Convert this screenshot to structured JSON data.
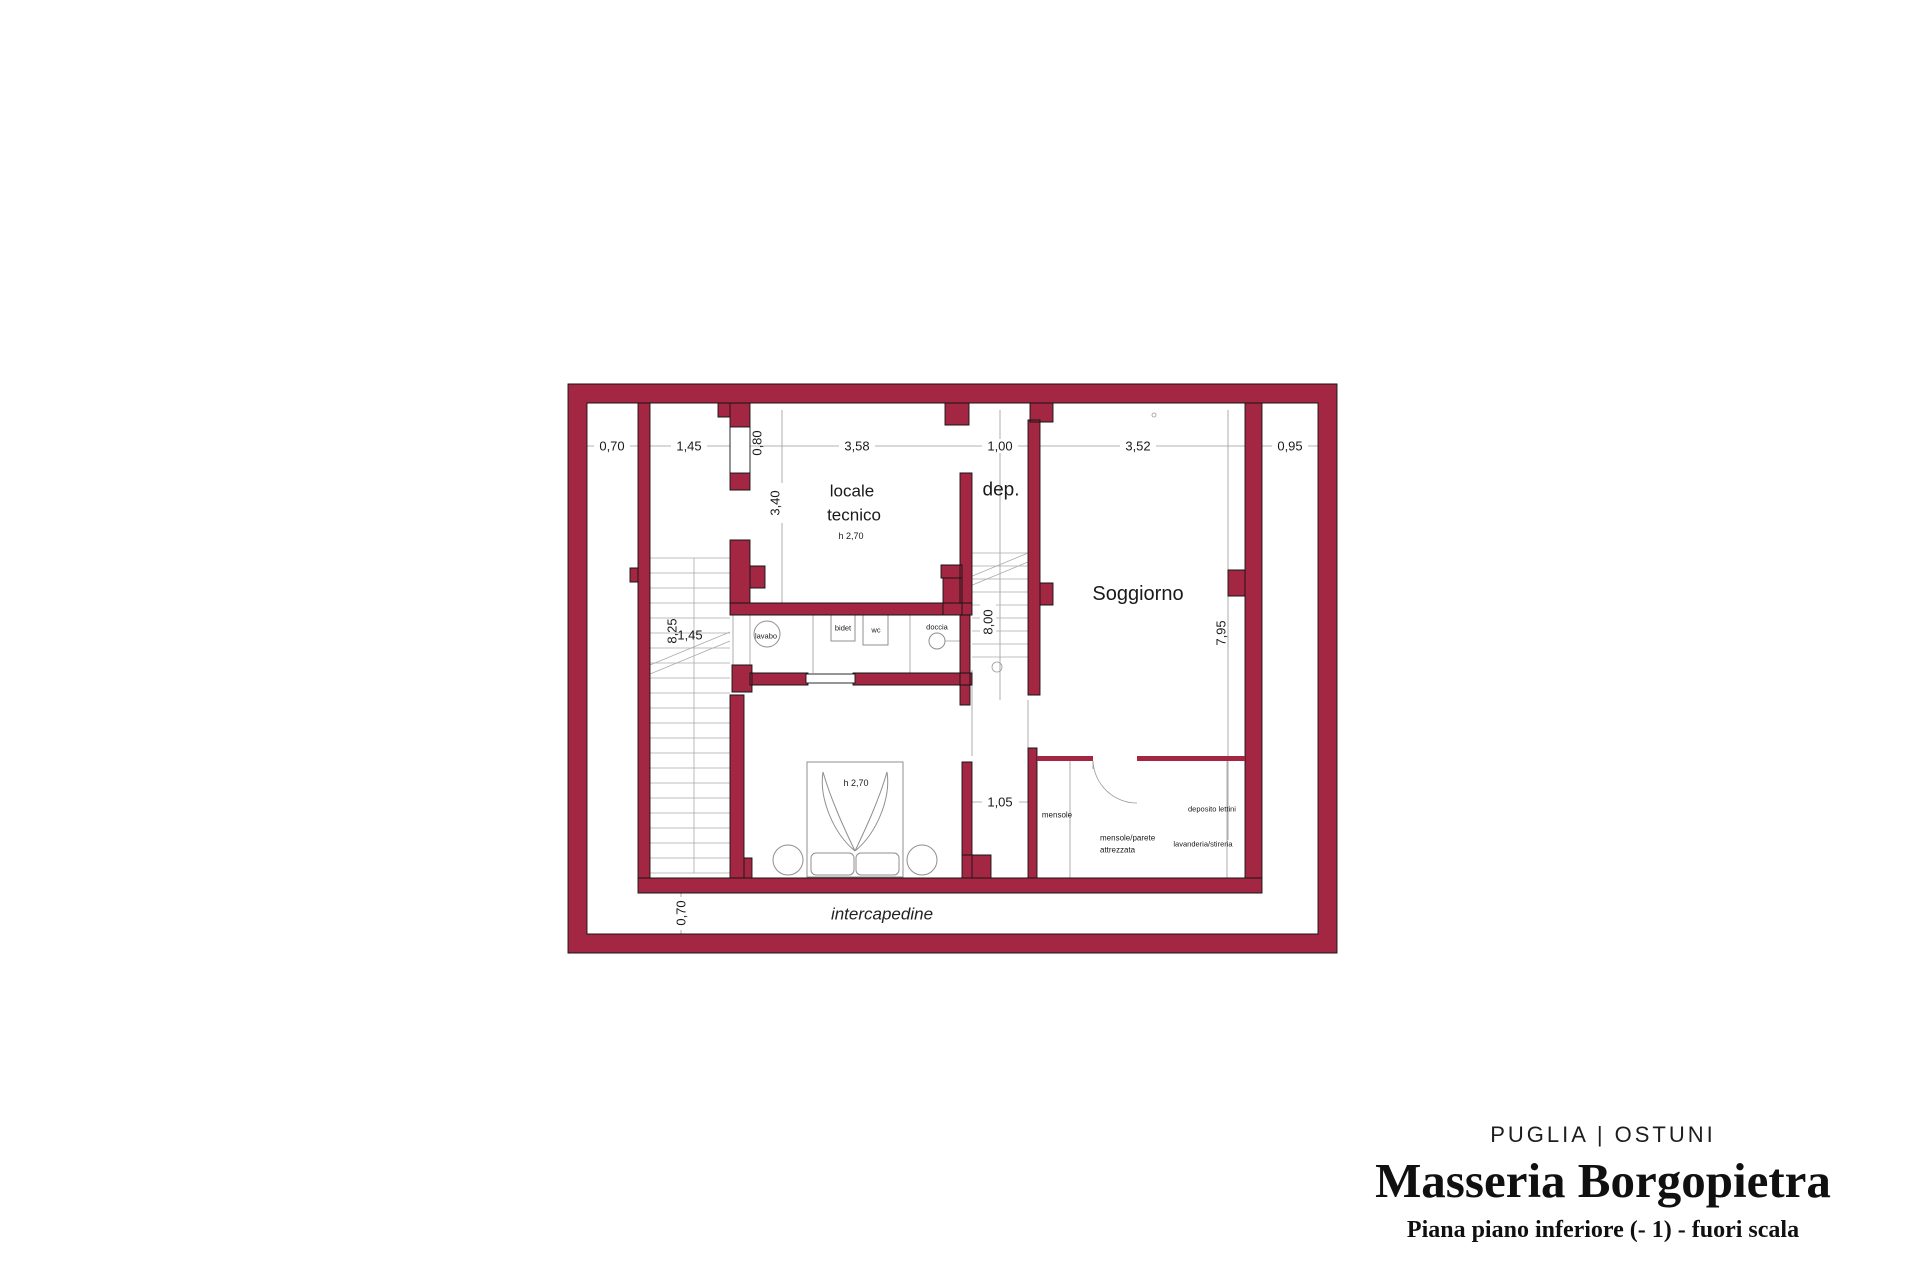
{
  "title_block": {
    "location": "PUGLIA | OSTUNI",
    "name": "Masseria Borgopietra",
    "subtitle": "Piana piano inferiore (- 1) - fuori scala"
  },
  "rooms": {
    "locale_tecnico_line1": "locale",
    "locale_tecnico_line2": "tecnico",
    "locale_tecnico_height": "h 2,70",
    "dep": "dep.",
    "soggiorno": "Soggiorno",
    "bedroom_height": "h 2,70",
    "intercapedine": "intercapedine"
  },
  "fixtures": {
    "lavabo": "lavabo",
    "bidet": "bidet",
    "wc": "wc",
    "doccia": "doccia"
  },
  "storage": {
    "mensole": "mensole",
    "deposito_lettini": "deposito lettini",
    "mensole_parete_line1": "mensole/parete",
    "mensole_parete_line2": "attrezzata",
    "lavanderia": "lavanderia/stireria"
  },
  "dims": {
    "top_070": "0,70",
    "top_145": "1,45",
    "top_080": "0,80",
    "top_358": "3,58",
    "top_100": "1,00",
    "top_352": "3,52",
    "top_095": "0,95",
    "left_340": "3,40",
    "stairs_825": "8,25",
    "stairs_145": "1,45",
    "mid_800": "8,00",
    "right_795": "7,95",
    "bottom_105": "1,05",
    "bottom_070": "0,70"
  },
  "colors": {
    "wall": "#A32742",
    "line": "#9A9A9A"
  }
}
